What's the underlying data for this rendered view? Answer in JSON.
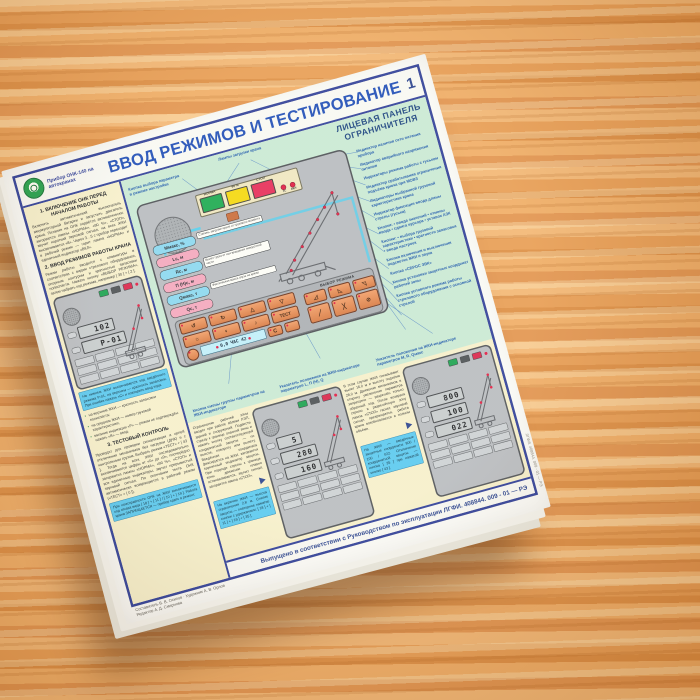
{
  "header": {
    "logo_caption": "Прибор ОНК-140 на автокранах",
    "title": "ВВОД РЕЖИМОВ И ТЕСТИРОВАНИЕ",
    "page_number": "1"
  },
  "panel": {
    "subtitle_line1": "ЛИЦЕВАЯ ПАНЕЛЬ",
    "subtitle_line2": "ОГРАНИЧИТЕЛЯ",
    "lamps": {
      "norm": "НОРМА",
      "warn": "90 %",
      "stop": "СТОП",
      "ts": "ТС",
      "on": "ВКЛ"
    },
    "params": [
      "Mмакс, %",
      "Lс, м",
      "Rс, м",
      "П (Н)с, м",
      "Qмакс, т",
      "Qс, т"
    ],
    "param_notes": [
      "Степень загрузки крана от грузового момента",
      "Вылет груза от оси вращения поворотной части",
      "Фактическая масса груза на крюке"
    ],
    "keypad": {
      "mode_header": "ВЫБОР РЕЖИМА",
      "test_label": "ТЕСТ",
      "clear_label": "C",
      "lcd_text": "0,0 ЧАС 42",
      "icons_row1": [
        "↺",
        "↻",
        "△",
        "▽"
      ],
      "icons_row2": [
        "☼",
        "◐",
        "♪"
      ],
      "mode_icons_row1": [
        "◿",
        "◺",
        "◹"
      ],
      "mode_icons_row2": [
        "╱",
        "╳",
        "⊘"
      ]
    },
    "callout_top": "Лампы загрузки крана",
    "callout_left": "Кнопка выбора параметра в режиме настройки",
    "callouts_right": [
      "Индикатор наличия сети питания прибора",
      "Индикатор аварийного напряжения питания",
      "Индикаторы режима работы с гуськом",
      "Индикатор срабатывания ограничения подъёма крюка при МОВЗ",
      "Индикаторы выбранной грузовой характеристики крана",
      "Индикатор фиксации ввода длины стрелы (гуська)",
      "Кнопки: • ввода значений • отмены ввода • сдвига курсора • уставок АЗК",
      "Кнопки: • выбора грузовой характеристики • кратности запасовки • ввода настроек",
      "Кнопка включения и выключения подсветки ЖКИ и звука",
      "Кнопка «СБРОС ЗВК»",
      "Кнопка установки защитных координат рабочей зоны",
      "Кнопка условного режима работы стрелового оборудования с основной стрелой"
    ],
    "callouts_bottom": [
      "Кнопка смены группы параметров на ЖКИ-индикаторе",
      "Указатель положения на ЖКИ-индикаторе параметров L, П (Н), Q",
      "Указатель положения на ЖКИ-индикаторе параметров M, R, Qмакс"
    ]
  },
  "left_column": {
    "s1_title": "1. ВКЛЮЧЕНИЕ ОНК ПЕРЕД НАЧАЛОМ РАБОТЫ",
    "s1_body": "Включить автоматический выключатель аккумуляторной батареи и запустить двигатель крана. Питание на ОНК подаётся автоматически: загораются лампы «НОРМА», «90 %», «СТОП», звучит короткий звуковой сигнал, на всех ЖКИ высвечивается «8». Через 3…5 с прибор переходит в рабочий режим — горит лампа «НОРМА» и единичный индикатор «ВКЛ».",
    "s2_title": "2. ВВОД РЕЖИМОВ РАБОТЫ КРАНА",
    "s2_body": "Режим работы вводится с клавиатуры в соответствии с видом стрелового оборудования, опорным контуром и кратностью запасовки полиспаста. Нажать кнопку «ВЫБОР РЕЖИМА», затем набрать код режима, например [ 30 ] + [ 2 ]:",
    "note1": "На нижнем ЖКИ высвечивается код введённого режима Р-01, на верхнем — кратность запасовки. При ошибке нажать «С» и повторить ввод кода.",
    "bullets": [
      "на верхнем ЖКИ — кратность запасовки полиспаста;",
      "на среднем ЖКИ — номер грузовой характеристики;",
      "мигание индикации «Р» — режим не подтверждён: нажать «В» — ввод."
    ],
    "s3_title": "3. ТЕСТОВЫЙ КОНТРОЛЬ",
    "s3_body": "Проводят для проверки сигнализации и цепей отключения механизмов без нагрузки (ДНК) и с контрольным грузом. Выбрать режим «ТЕСТ» + [ 43 ]. Тогда на всех ЖКИ последовательно высвечиваются цифры от «0» до «9», поочерёдно загораются лампы «НОРМА», «90 %», «СТОП» и все единичные индикаторы, звучит прерывистый звуковой сигнал. По окончании теста ОНК автоматически возвращается в рабочий режим («ТЕСТ» + [ 0 ]).",
    "note2": "При неисправности ОНК на ЖКИ высвечивается код отказа вида [ 18 ] + [ 11 ] / [ 10 ] + [ 19 ]. Работа крана ЗАПРЕЩАЕТСЯ — прибор сдать в ремонт."
  },
  "band": {
    "col1_body": "Ограничение рабочей зоны вводят при работе вблизи ЛЭП, зданий и сооружений. Подвести стрелу к границе опасной зоны и нажать кнопку соответствующей координатной защиты — по высоте, повороту или вылету. Введённая координата фиксируется на ЖКИ, загорается единичный индикатор защиты. При подходе стрелы к границе зоны движение плавно останавливается, звучит сигнал, загорается лампа «СТОП».",
    "col1_note": "На верхнем ЖКИ — высота ограничения 2,8 м. Снятие защиты — повторное нажатие кнопки с удержанием: [ 18 ] + [ 11 ] + [ 19 ] + [ 35 ].",
    "col2_body": "В этом случае ЖКИ показывают вылет 16,0 м и высоту подъёма 28,0 м. Движение механизмов в сторону увеличения параметра запрещено — разрешён только обратный ход. После возврата стрелы в разрешённую зону лампа «СТОП» гаснет, звуковой сигнал прекращается, работа крана возобновляется в полном объёме.",
    "col2_note": "На ЖКИ — введённые защитные координаты 800 / 100 / 022. Отключение координатной защиты — кнопка [ 35 ] при нажатой кнопке [ 43 ]."
  },
  "displays": {
    "panel_a": [
      "102",
      "Р-01"
    ],
    "panel_b": [
      "5",
      "280",
      "160"
    ],
    "panel_c": [
      "800",
      "100",
      "022"
    ]
  },
  "footer": {
    "issue": "Выпущено в соответствии с Руководством по эксплуатации ЛГФИ. 408844. 009 - 01 — РЭ",
    "credits_line1": "Составитель В. В. Осипов  ·  Художник А. В. Орлов",
    "credits_line2": "Редактор А. Д. Смирнова",
    "edge_text": "ЛГФИ. 408844. 009 - 01 — РЭ"
  }
}
